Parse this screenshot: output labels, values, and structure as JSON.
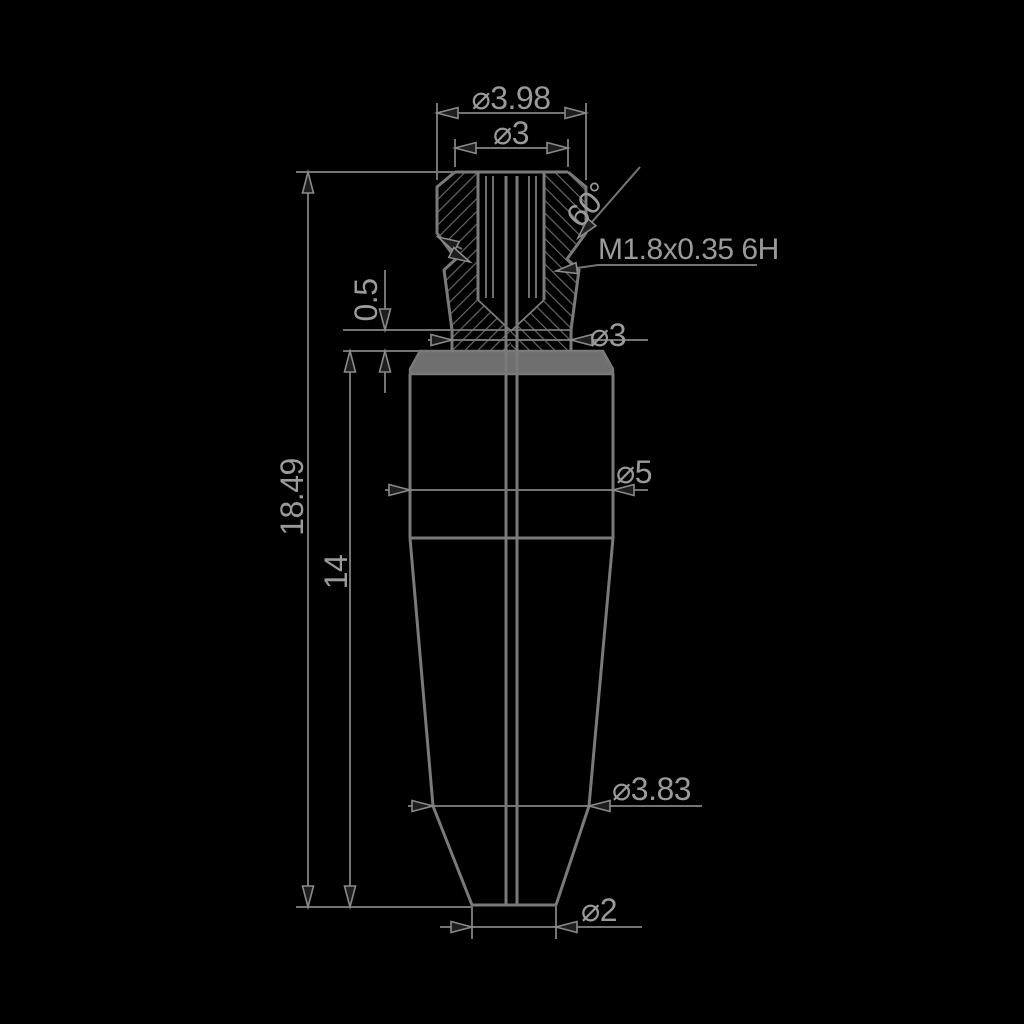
{
  "drawing": {
    "title": "threaded-nozzle-section-view",
    "background_color": "#000000",
    "line_color": "#7a7a7a",
    "text_color": "#9a9a9a",
    "dimensions": {
      "top_outer_diameter": "⌀3.98",
      "top_face_diameter": "⌀3",
      "groove_angle": "60°",
      "thread_spec": "M1.8x0.35 6H",
      "collar_thickness": "0.5",
      "neck_diameter": "⌀3",
      "overall_height": "18.49",
      "body_height": "14",
      "body_diameter": "⌀5",
      "cone_diameter": "⌀3.83",
      "tip_diameter": "⌀2"
    }
  }
}
